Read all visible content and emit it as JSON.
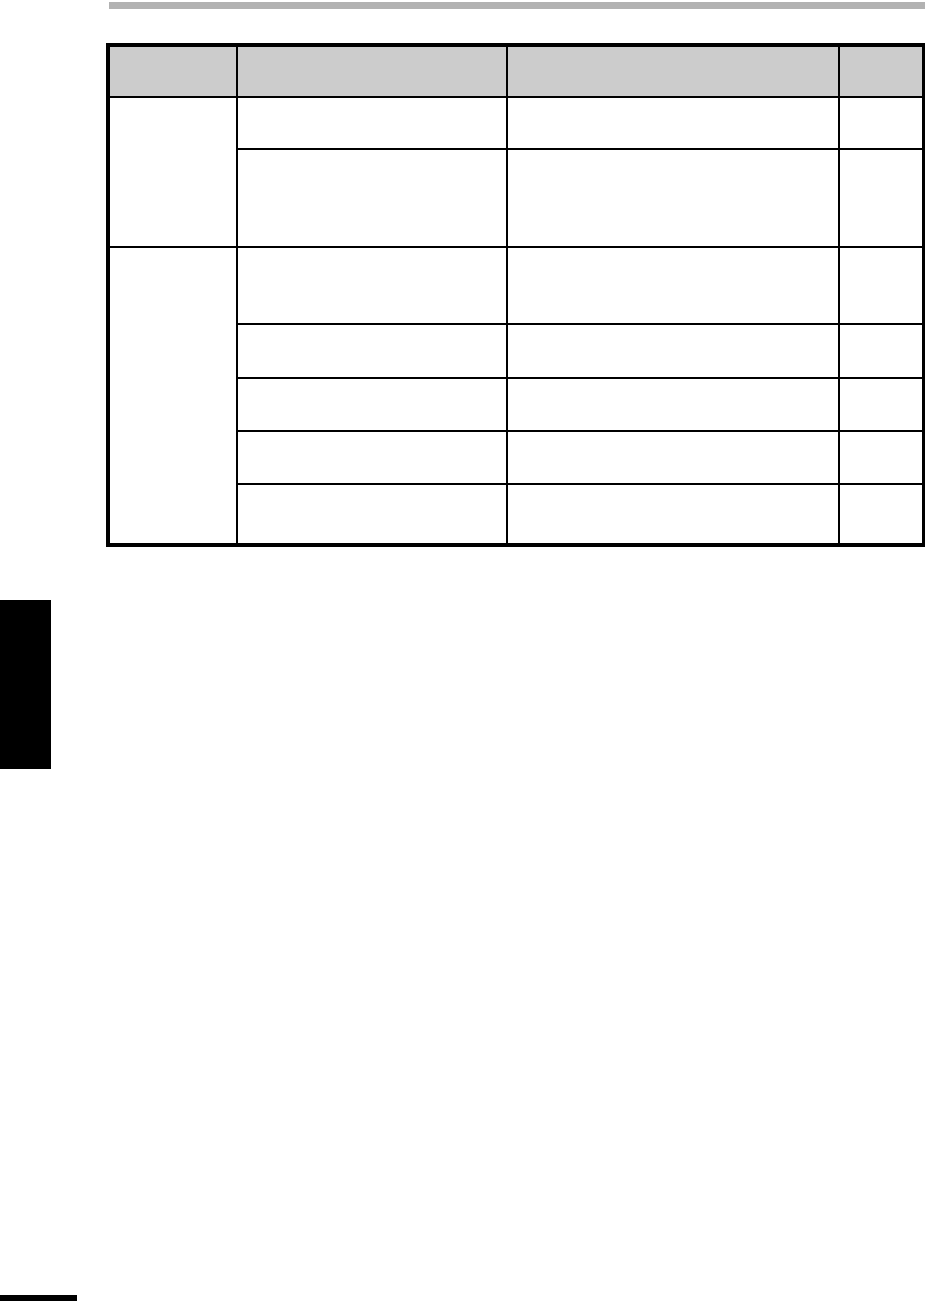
{
  "page": {
    "background_color": "#ffffff"
  },
  "top_bar": {
    "color": "#b2b2b2"
  },
  "table": {
    "border_color": "#000000",
    "header_background": "#cccccc",
    "header_cells": [
      "",
      "",
      "",
      ""
    ],
    "body": {
      "group1": {
        "label": "",
        "rows": [
          [
            "",
            "",
            ""
          ],
          [
            "",
            "",
            ""
          ]
        ]
      },
      "group2": {
        "label": "",
        "rows": [
          [
            "",
            "",
            ""
          ],
          [
            "",
            "",
            ""
          ],
          [
            "",
            "",
            ""
          ],
          [
            "",
            "",
            ""
          ],
          [
            "",
            "",
            ""
          ]
        ]
      }
    }
  },
  "side_tab": {
    "color": "#000000"
  },
  "footer_mark": {
    "color": "#000000"
  }
}
